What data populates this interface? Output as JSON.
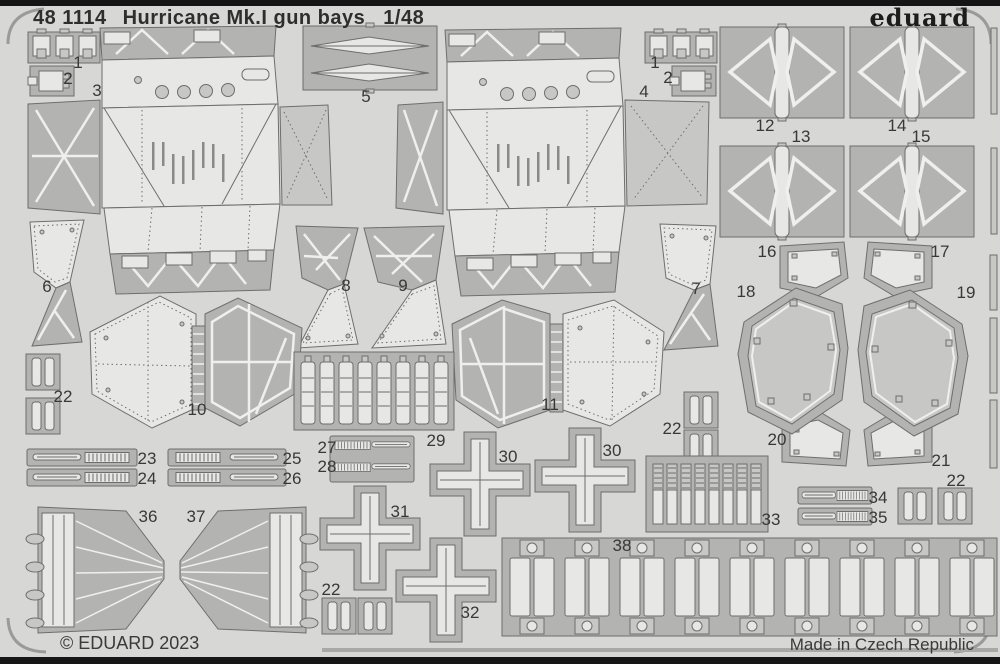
{
  "header": {
    "catalog": "48 1114",
    "title": "Hurricane Mk.I gun bays",
    "scale": "1/48",
    "brand": "eduard"
  },
  "footer": {
    "copyright": "© EDUARD 2023",
    "made_in": "Made in Czech Republic"
  },
  "colors": {
    "sheet": "#d7d7d5",
    "dark": "#b3b3b1",
    "mid": "#c7c7c5",
    "light": "#e7e7e5",
    "outline": "#6e6e6c",
    "etch": "#efefed",
    "ink": "#2e2e2e",
    "border": "#151515"
  },
  "part_labels": [
    {
      "n": "1",
      "x": 78,
      "y": 63
    },
    {
      "n": "2",
      "x": 68,
      "y": 79
    },
    {
      "n": "3",
      "x": 97,
      "y": 91
    },
    {
      "n": "5",
      "x": 366,
      "y": 97
    },
    {
      "n": "1",
      "x": 655,
      "y": 63
    },
    {
      "n": "2",
      "x": 668,
      "y": 78
    },
    {
      "n": "4",
      "x": 644,
      "y": 92
    },
    {
      "n": "12",
      "x": 765,
      "y": 126
    },
    {
      "n": "13",
      "x": 801,
      "y": 137
    },
    {
      "n": "14",
      "x": 897,
      "y": 126
    },
    {
      "n": "15",
      "x": 921,
      "y": 137
    },
    {
      "n": "16",
      "x": 767,
      "y": 252
    },
    {
      "n": "17",
      "x": 940,
      "y": 252
    },
    {
      "n": "18",
      "x": 746,
      "y": 292
    },
    {
      "n": "19",
      "x": 966,
      "y": 293
    },
    {
      "n": "6",
      "x": 47,
      "y": 287
    },
    {
      "n": "8",
      "x": 346,
      "y": 286
    },
    {
      "n": "9",
      "x": 403,
      "y": 286
    },
    {
      "n": "7",
      "x": 696,
      "y": 289
    },
    {
      "n": "10",
      "x": 197,
      "y": 410
    },
    {
      "n": "11",
      "x": 550,
      "y": 405
    },
    {
      "n": "22",
      "x": 63,
      "y": 397
    },
    {
      "n": "23",
      "x": 147,
      "y": 459
    },
    {
      "n": "24",
      "x": 147,
      "y": 479
    },
    {
      "n": "25",
      "x": 292,
      "y": 459
    },
    {
      "n": "26",
      "x": 292,
      "y": 479
    },
    {
      "n": "27",
      "x": 327,
      "y": 448
    },
    {
      "n": "28",
      "x": 327,
      "y": 467
    },
    {
      "n": "29",
      "x": 436,
      "y": 441
    },
    {
      "n": "30",
      "x": 508,
      "y": 457
    },
    {
      "n": "30",
      "x": 612,
      "y": 451
    },
    {
      "n": "31",
      "x": 400,
      "y": 512
    },
    {
      "n": "32",
      "x": 470,
      "y": 613
    },
    {
      "n": "22",
      "x": 672,
      "y": 429
    },
    {
      "n": "33",
      "x": 771,
      "y": 520
    },
    {
      "n": "34",
      "x": 878,
      "y": 498
    },
    {
      "n": "35",
      "x": 878,
      "y": 518
    },
    {
      "n": "22",
      "x": 956,
      "y": 481
    },
    {
      "n": "36",
      "x": 148,
      "y": 517
    },
    {
      "n": "37",
      "x": 196,
      "y": 517
    },
    {
      "n": "38",
      "x": 622,
      "y": 546
    },
    {
      "n": "20",
      "x": 777,
      "y": 440
    },
    {
      "n": "21",
      "x": 941,
      "y": 461
    },
    {
      "n": "22",
      "x": 331,
      "y": 590
    }
  ]
}
